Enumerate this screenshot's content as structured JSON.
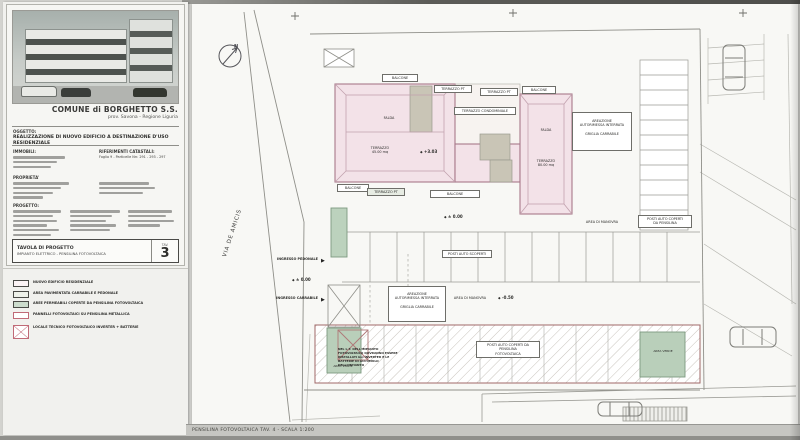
{
  "titleblock": {
    "commune": "COMUNE di BORGHETTO S.S.",
    "province": "prov. Savona - Regione Liguria",
    "oggetto_label": "OGGETTO:",
    "oggetto_text": "REALIZZAZIONE DI NUOVO EDIFICIO A DESTINAZIONE D'USO RESIDENZIALE",
    "immobili_label": "IMMOBILI:",
    "catasto_label": "RIFERIMENTI CATASTALI:",
    "catasto_text": "Foglio 9 - Particelle Nrr. 291 - 293 - 297",
    "proprieta_label": "PROPRIETA'",
    "progetto_label": "PROGETTO:",
    "tavola_label": "TAVOLA DI PROGETTO",
    "tavola_subject": "IMPIANTO ELETTRICO - PENSILINA FOTOVOLTAICA",
    "tav_caption": "TAV.",
    "tav_number": "3"
  },
  "legend": {
    "items": [
      {
        "label": "NUOVO EDIFICIO RESIDENZIALE"
      },
      {
        "label": "AREA PAVIMENTATA CARRABILE E PEDONALE"
      },
      {
        "label": "AREE PERMEABILI COPERTE DA PENSILINA FOTOVOLTAICA"
      },
      {
        "label": "PANNELLI FOTOVOLTAICI SU PENSILINA METALLICA"
      },
      {
        "label": "LOCALE TECNICO FOTOVOLTAICO INVERTER + BATTERIE"
      }
    ]
  },
  "plan": {
    "street": "VIA DE AMICIS",
    "north": "N",
    "labels": {
      "balcone": "BALCONE",
      "terrazzo_pt": "TERRAZZO PT",
      "falda": "FALDA",
      "terrazzo_condominiale": "TERRAZZO CONDOMINIALE",
      "terrazzo_45_l1": "TERRAZZO",
      "terrazzo_45_l2": "45.00 mq",
      "terrazzo_80_l1": "TERRAZZO",
      "terrazzo_80_l2": "80.00 mq",
      "areazione_l1": "AREAZIONE",
      "areazione_l2": "AUTORIMESSA INTERRATA",
      "areazione_l3": "GRIGLIA CARRABILE",
      "area_manovra": "AREA DI MANOVRA",
      "posti_scoperti": "POSTI AUTO SCOPERTI",
      "posti_coperti_l1": "POSTI AUTO COPERTI",
      "posti_coperti_l2": "DA PENSILINA",
      "posti_fv_l1": "POSTI AUTO COPERTI DA PENSILINA",
      "posti_fv_l2": "FOTOVOLTAICA",
      "area_verde": "AREA VERDE",
      "ingresso_pedonale": "INGRESSO PEDONALE",
      "ingresso_carrabile": "INGRESSO CARRABILE",
      "nota_lt": "NEL L.T. DELL'IMPIANTO FOTOVOLTAICO DOVRANNO ESSERE INSTALLATI GLI INVERTER E LE BATTERIE DI ACCUMULO DELL'IMPIANTO",
      "quota_sym": "◆",
      "quota_303": "+3.03",
      "quota_000": "± 0.00",
      "quota_m050": "-0.50",
      "arrow_right": "▶"
    },
    "footer": "PENSILINA FOTOVOLTAICA TAV. 4 - SCALA 1:200"
  }
}
